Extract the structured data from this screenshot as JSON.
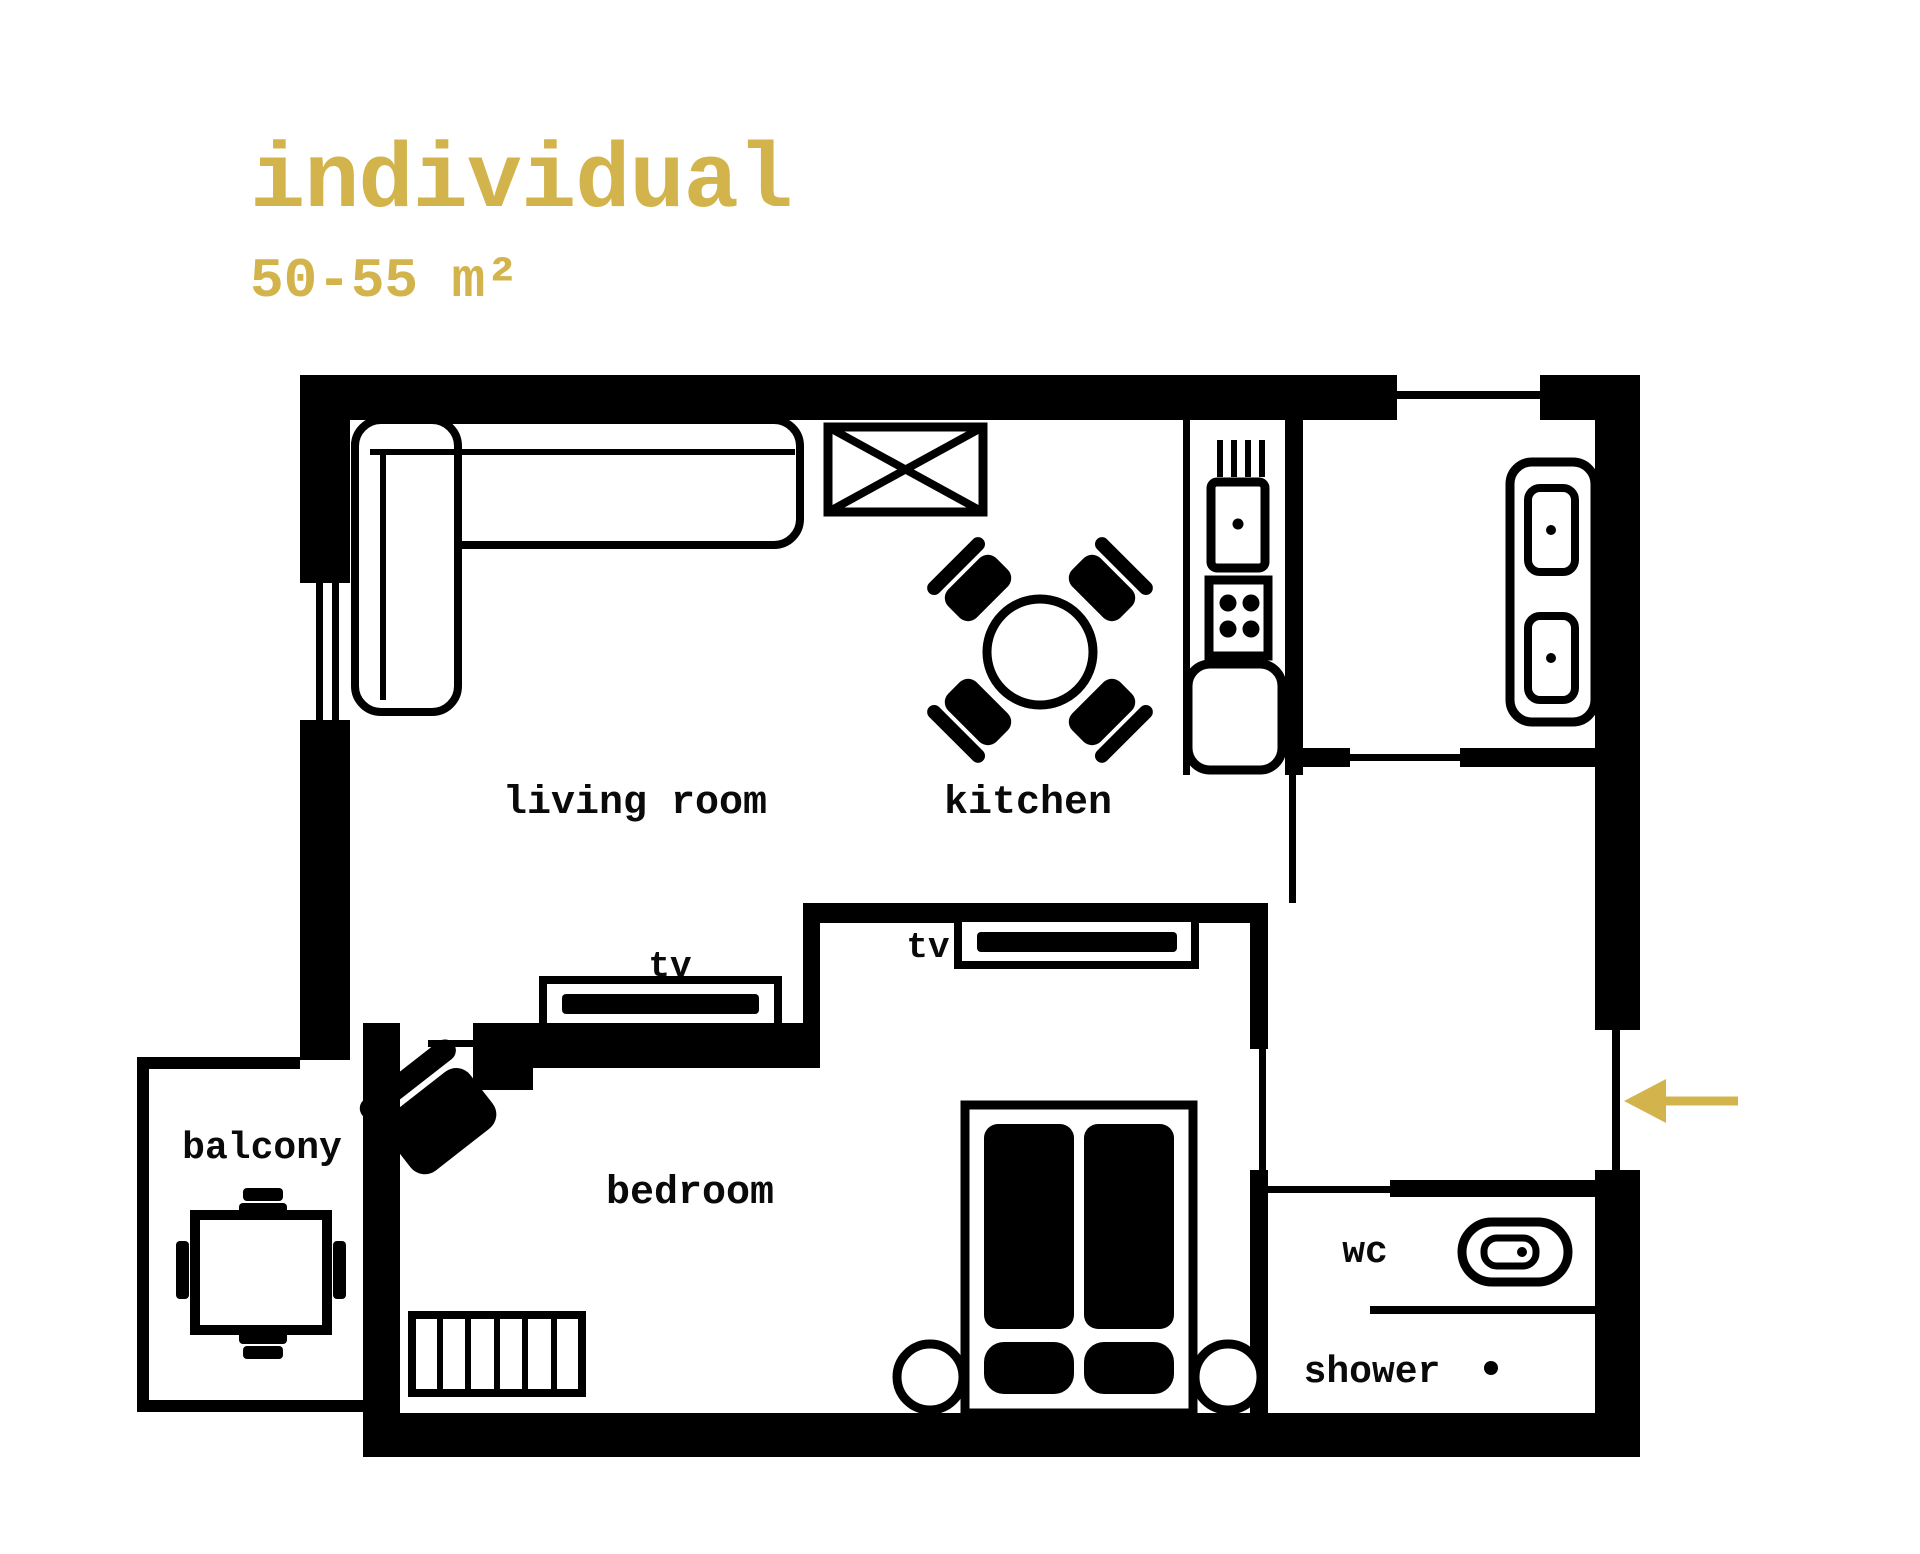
{
  "page": {
    "background": "#ffffff",
    "type": "apartment floor plan"
  },
  "header": {
    "title": "individual",
    "area": "50-55 m²",
    "accent_color": "#d3b44c"
  },
  "plan": {
    "wall_color": "#000000",
    "floor_color": "#ffffff",
    "entrance_arrow_color": "#d3b44c"
  },
  "rooms": {
    "living_room": {
      "label": "living room"
    },
    "kitchen": {
      "label": "kitchen"
    },
    "bedroom": {
      "label": "bedroom"
    },
    "balcony": {
      "label": "balcony"
    },
    "wc": {
      "label": "wc"
    },
    "shower": {
      "label": "shower"
    },
    "tv_living": {
      "label": "tv"
    },
    "tv_bedroom": {
      "label": "tv"
    }
  }
}
